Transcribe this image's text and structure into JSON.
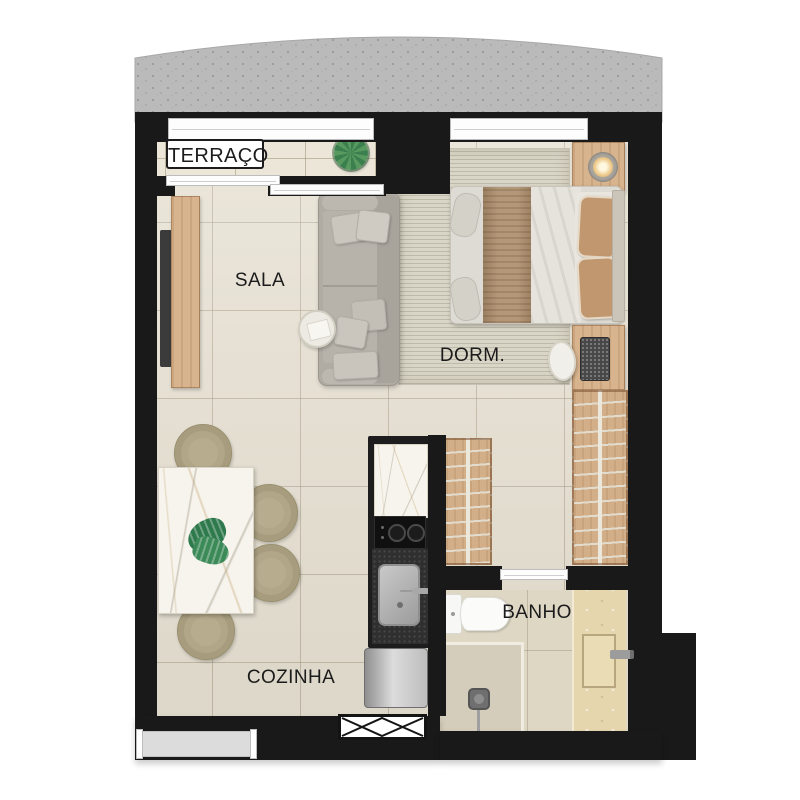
{
  "floorplan": {
    "type": "studio-apartment-floor-plan",
    "labels": {
      "terrace": "TERRAÇO",
      "living_room": "SALA",
      "bedroom": "DORM.",
      "bathroom": "BANHO",
      "kitchen": "COZINHA"
    },
    "colors": {
      "wall": "#191919",
      "floor": "#e6e0d1",
      "terrace_floor": "#ece6d8",
      "bathroom_floor": "#ded7c4",
      "concrete_slab": "#bababa",
      "wood_furniture": "#d8b48e",
      "sofa_gray": "#b0aca4",
      "marble": "#f7f4ee",
      "plant_green": "#2f7a4d",
      "dining_chair_olive": "#b7ac8e"
    },
    "furniture": {
      "terrace": [
        "potted-plant",
        "sliding-door",
        "window"
      ],
      "living_room": [
        "tv-console",
        "tv",
        "sofa",
        "throw-pillows",
        "round-side-table"
      ],
      "bedroom": [
        "area-rug",
        "double-bed",
        "nightstand",
        "table-lamp",
        "desk",
        "laptop",
        "desk-chair",
        "wardrobe-with-hangers",
        "window"
      ],
      "closet": [
        "wardrobe-with-hangers"
      ],
      "kitchen": [
        "marble-counter",
        "cooktop",
        "kitchen-sink",
        "refrigerator",
        "dining-table",
        "dining-chairs",
        "monstera-leaf",
        "duct-shaft"
      ],
      "bathroom": [
        "toilet",
        "shower",
        "shower-head",
        "stone-vanity",
        "recessed-sink",
        "faucet",
        "sliding-door"
      ]
    }
  }
}
